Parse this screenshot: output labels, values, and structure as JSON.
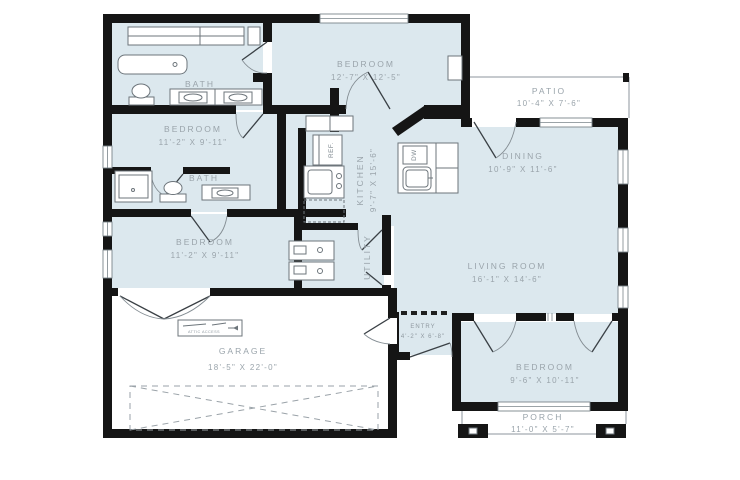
{
  "page": {
    "type": "floor-plan"
  },
  "colors": {
    "wall": "#151515",
    "room_fill": "#dce8ee",
    "label_text": "#9aa4ab",
    "fixture_line": "#6d757b",
    "outdoor_line": "#8d969c",
    "background": "#ffffff"
  },
  "rooms": {
    "bedroom1": {
      "label": "BEDROOM",
      "dims": "12'-7\" X 12'-5\""
    },
    "patio": {
      "label": "PATIO",
      "dims": "10'-4\" X 7'-6\""
    },
    "bedroom2": {
      "label": "BEDROOM",
      "dims": "11'-2\" X 9'-11\""
    },
    "bath1": {
      "label": "BATH"
    },
    "bath2": {
      "label": "BATH"
    },
    "bedroom3": {
      "label": "BEDROOM",
      "dims": "11'-2\" X 9'-11\""
    },
    "kitchen": {
      "label": "KITCHEN",
      "dims": "9'-7\" X 15'-6\""
    },
    "dining": {
      "label": "DINING",
      "dims": "10'-9\" X 11'-6\""
    },
    "living": {
      "label": "LIVING ROOM",
      "dims": "16'-1\" X 14'-6\""
    },
    "entry": {
      "label": "ENTRY",
      "dims": "4'-2\" X 6'-8\""
    },
    "utility": {
      "label": "UTILITY"
    },
    "bedroom4": {
      "label": "BEDROOM",
      "dims": "9'-6\" X 10'-11\""
    },
    "porch": {
      "label": "PORCH",
      "dims": "11'-0\" X 5'-7\""
    },
    "garage": {
      "label": "GARAGE",
      "dims": "18'-5\" X 22'-0\""
    }
  },
  "appliances": {
    "refrigerator": "REF.",
    "dishwasher": "DW",
    "attic_access": "ATTIC ACCESS"
  }
}
